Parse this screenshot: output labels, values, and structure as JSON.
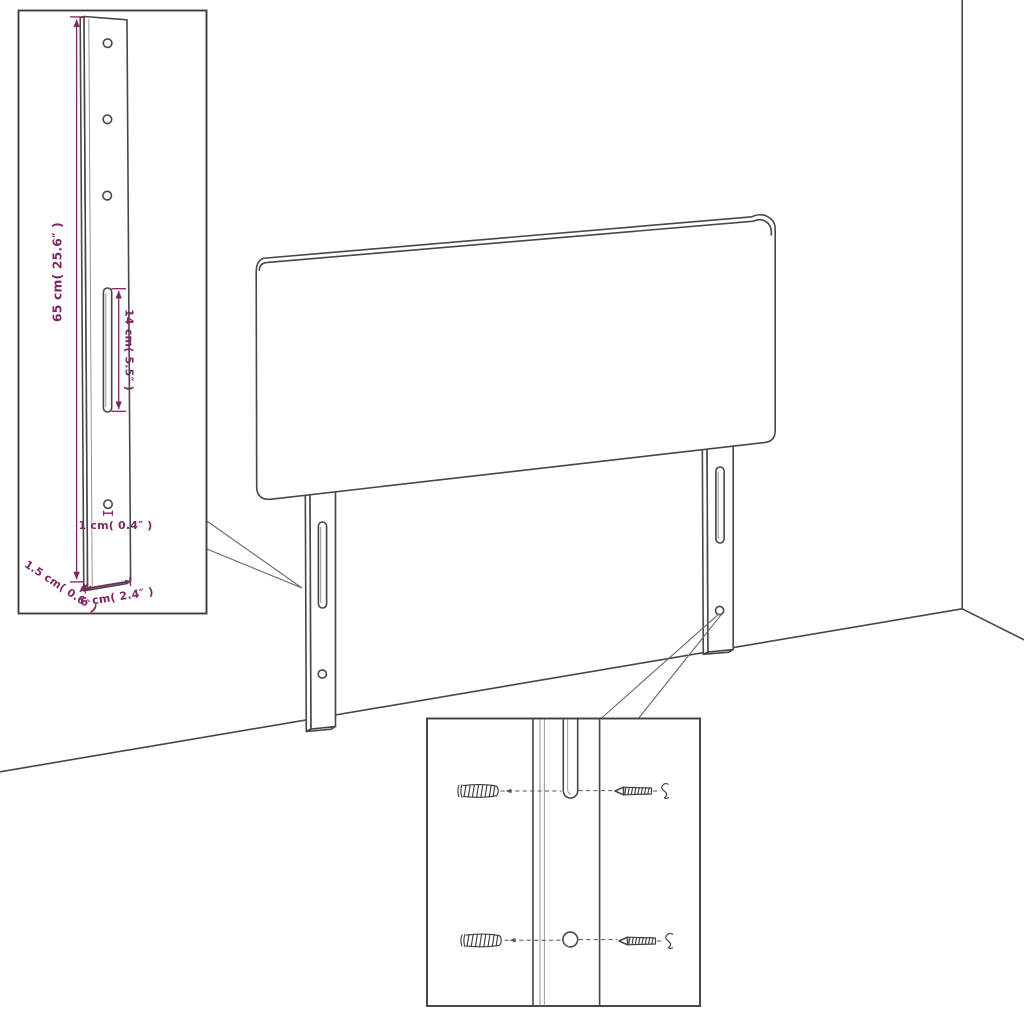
{
  "colors": {
    "background": "#ffffff",
    "line": "#474747",
    "dimension_accent": "#7d2664"
  },
  "leg_detail_inset": {
    "dimensions": {
      "leg_height": "65 cm( 25.6″ )",
      "slot_length": "14 cm( 5.5″ )",
      "hole_diameter": "1 cm( 0.4″ )",
      "leg_thickness": "1.5 cm( 0.6″ )",
      "leg_width": "6 cm( 2.4″ )"
    }
  },
  "mounting_detail_inset": {
    "icons": [
      "wall-plug-icon",
      "screw-icon",
      "slot-icon",
      "hole-icon"
    ]
  }
}
